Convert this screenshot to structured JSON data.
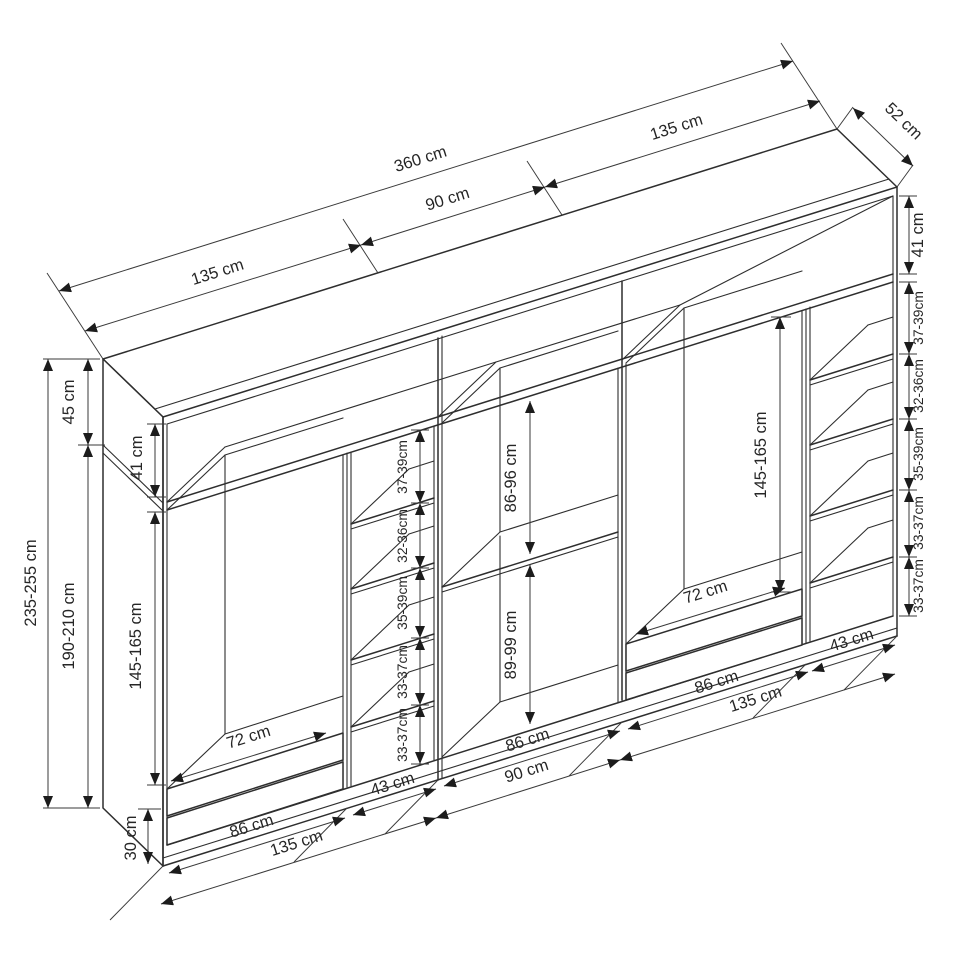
{
  "meta": {
    "type": "furniture-dimension-diagram",
    "subject": "three-section wardrobe axonometric line drawing",
    "unit": "cm",
    "line_color": "#2e2e2e",
    "background": "#ffffff"
  },
  "dims": {
    "top": {
      "left_section": "135 cm",
      "total": "360 cm",
      "middle_section": "90 cm",
      "right_section": "135 cm",
      "depth": "52 cm"
    },
    "left_outside": {
      "total_height": "235-255 cm",
      "top_box_height": "45 cm",
      "carcass_height": "190-210 cm",
      "plinth_height": "30 cm"
    },
    "left_interior": {
      "top_box_interior": "41 cm",
      "hanging_height": "145-165 cm",
      "rod_width": "72 cm"
    },
    "left_shelf_gaps": [
      "37-39cm",
      "32-36cm",
      "35-39cm",
      "33-37cm",
      "33-37cm"
    ],
    "middle_interior": {
      "upper_compartment": "86-96 cm",
      "lower_compartment": "89-99 cm"
    },
    "right_interior": {
      "hanging_height": "145-165 cm",
      "rod_width": "72 cm"
    },
    "right_outside": {
      "top_box_interior": "41 cm",
      "shelf_gaps": [
        "37-39cm",
        "32-36cm",
        "35-39cm",
        "33-37cm",
        "33-37cm"
      ]
    },
    "bottom": {
      "left_interior_width": "86 cm",
      "left_shelf_col_width": "43 cm",
      "left_section_width": "135 cm",
      "middle_interior_width": "86 cm",
      "middle_section_width": "90 cm",
      "right_interior_width": "86 cm",
      "right_shelf_col_width": "43 cm",
      "right_section_width": "135 cm"
    }
  }
}
